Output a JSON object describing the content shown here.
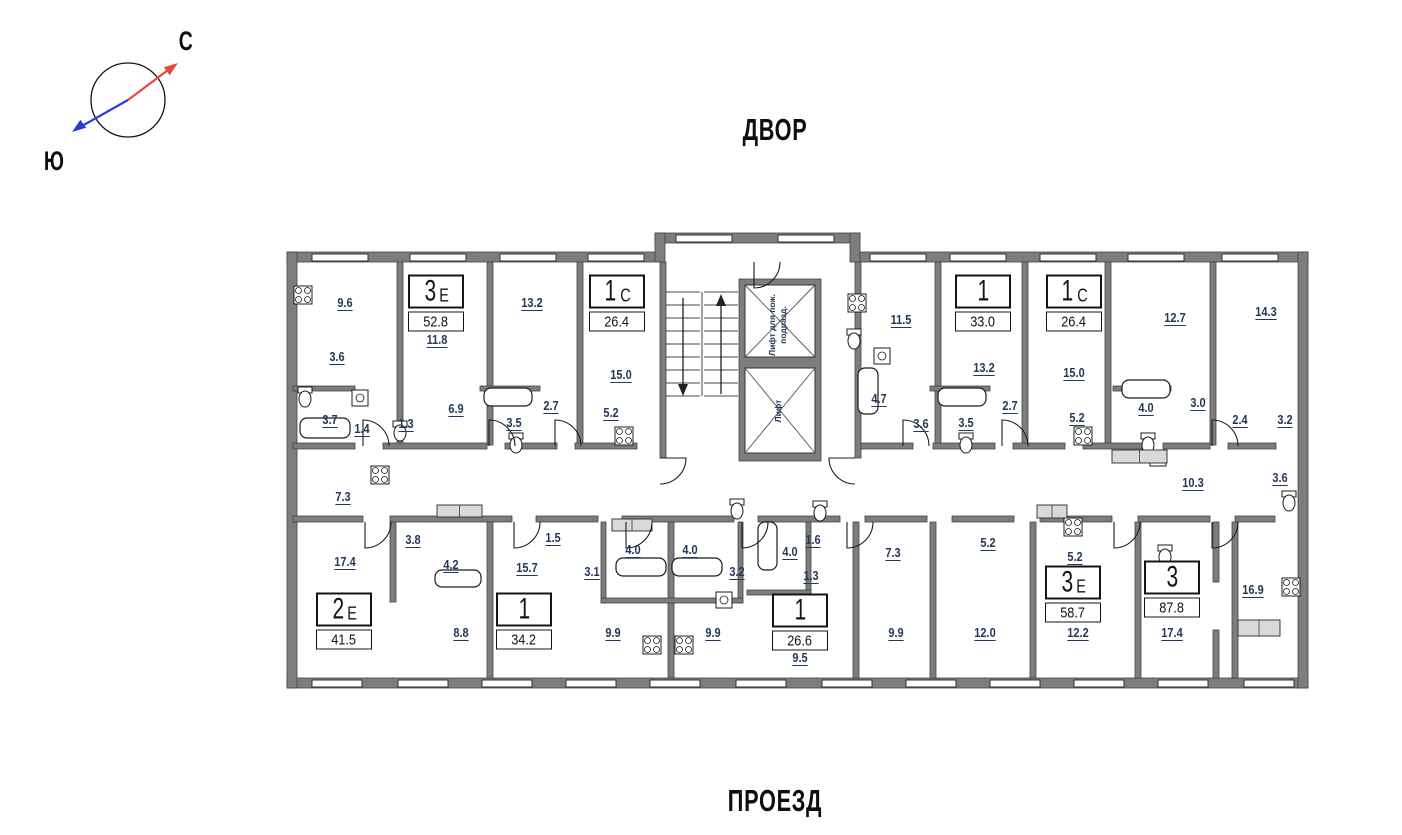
{
  "compass": {
    "north_label": "С",
    "south_label": "Ю"
  },
  "site": {
    "top_label": "ДВОР",
    "bottom_label": "ПРОЕЗД"
  },
  "elevators": [
    {
      "line1": "Лифт для пож.",
      "line2": "подразд."
    },
    {
      "line1": "Лифт",
      "line2": ""
    }
  ],
  "apartments": [
    {
      "num": "3",
      "suf": "Е",
      "area": "52.8",
      "x": 436,
      "y": 303
    },
    {
      "num": "1",
      "suf": "С",
      "area": "26.4",
      "x": 617,
      "y": 303
    },
    {
      "num": "1",
      "suf": "",
      "area": "33.0",
      "x": 983,
      "y": 303
    },
    {
      "num": "1",
      "suf": "С",
      "area": "26.4",
      "x": 1074,
      "y": 303
    },
    {
      "num": "2",
      "suf": "Е",
      "area": "41.5",
      "x": 344,
      "y": 621
    },
    {
      "num": "1",
      "suf": "",
      "area": "34.2",
      "x": 524,
      "y": 621
    },
    {
      "num": "1",
      "suf": "",
      "area": "26.6",
      "x": 800,
      "y": 622
    },
    {
      "num": "3",
      "suf": "Е",
      "area": "58.7",
      "x": 1073,
      "y": 594
    },
    {
      "num": "3",
      "suf": "",
      "area": "87.8",
      "x": 1172,
      "y": 589
    }
  ],
  "rooms": [
    {
      "a": "9.6",
      "x": 345,
      "y": 303
    },
    {
      "a": "3.6",
      "x": 337,
      "y": 357
    },
    {
      "a": "3.7",
      "x": 330,
      "y": 420
    },
    {
      "a": "1.4",
      "x": 362,
      "y": 429
    },
    {
      "a": "1.3",
      "x": 406,
      "y": 424
    },
    {
      "a": "11.8",
      "x": 437,
      "y": 340
    },
    {
      "a": "6.9",
      "x": 456,
      "y": 409
    },
    {
      "a": "13.2",
      "x": 532,
      "y": 303
    },
    {
      "a": "3.5",
      "x": 514,
      "y": 423
    },
    {
      "a": "2.7",
      "x": 551,
      "y": 406
    },
    {
      "a": "15.0",
      "x": 621,
      "y": 375
    },
    {
      "a": "5.2",
      "x": 611,
      "y": 413
    },
    {
      "a": "11.5",
      "x": 901,
      "y": 320
    },
    {
      "a": "4.7",
      "x": 879,
      "y": 399
    },
    {
      "a": "3.6",
      "x": 921,
      "y": 424
    },
    {
      "a": "13.2",
      "x": 984,
      "y": 368
    },
    {
      "a": "3.5",
      "x": 966,
      "y": 423
    },
    {
      "a": "2.7",
      "x": 1010,
      "y": 406
    },
    {
      "a": "15.0",
      "x": 1074,
      "y": 373
    },
    {
      "a": "5.2",
      "x": 1077,
      "y": 418
    },
    {
      "a": "4.0",
      "x": 1146,
      "y": 408
    },
    {
      "a": "12.7",
      "x": 1175,
      "y": 318
    },
    {
      "a": "3.0",
      "x": 1198,
      "y": 403
    },
    {
      "a": "14.3",
      "x": 1266,
      "y": 312
    },
    {
      "a": "2.4",
      "x": 1240,
      "y": 420
    },
    {
      "a": "3.2",
      "x": 1285,
      "y": 420
    },
    {
      "a": "7.3",
      "x": 343,
      "y": 497
    },
    {
      "a": "3.8",
      "x": 413,
      "y": 540
    },
    {
      "a": "4.2",
      "x": 451,
      "y": 565
    },
    {
      "a": "17.4",
      "x": 345,
      "y": 562
    },
    {
      "a": "8.8",
      "x": 461,
      "y": 633
    },
    {
      "a": "1.5",
      "x": 553,
      "y": 538
    },
    {
      "a": "15.7",
      "x": 527,
      "y": 568
    },
    {
      "a": "3.1",
      "x": 592,
      "y": 572
    },
    {
      "a": "4.0",
      "x": 633,
      "y": 550
    },
    {
      "a": "4.0",
      "x": 690,
      "y": 550
    },
    {
      "a": "3.2",
      "x": 737,
      "y": 572
    },
    {
      "a": "9.9",
      "x": 613,
      "y": 633
    },
    {
      "a": "9.9",
      "x": 713,
      "y": 633
    },
    {
      "a": "4.0",
      "x": 790,
      "y": 552
    },
    {
      "a": "1.6",
      "x": 813,
      "y": 540
    },
    {
      "a": "1.3",
      "x": 811,
      "y": 576
    },
    {
      "a": "9.5",
      "x": 800,
      "y": 658
    },
    {
      "a": "7.3",
      "x": 893,
      "y": 553
    },
    {
      "a": "9.9",
      "x": 896,
      "y": 633
    },
    {
      "a": "5.2",
      "x": 988,
      "y": 543
    },
    {
      "a": "12.0",
      "x": 985,
      "y": 633
    },
    {
      "a": "5.2",
      "x": 1075,
      "y": 557
    },
    {
      "a": "12.2",
      "x": 1078,
      "y": 633
    },
    {
      "a": "17.4",
      "x": 1172,
      "y": 633
    },
    {
      "a": "10.3",
      "x": 1193,
      "y": 483
    },
    {
      "a": "16.9",
      "x": 1253,
      "y": 590
    },
    {
      "a": "3.6",
      "x": 1280,
      "y": 478
    }
  ],
  "colors": {
    "wall": "#7d7d7d",
    "wall_edge": "#454545",
    "room_label": "#24375a",
    "apt_border": "#141414",
    "north_arrow": "#e8473f",
    "south_arrow": "#2b3bd6"
  }
}
